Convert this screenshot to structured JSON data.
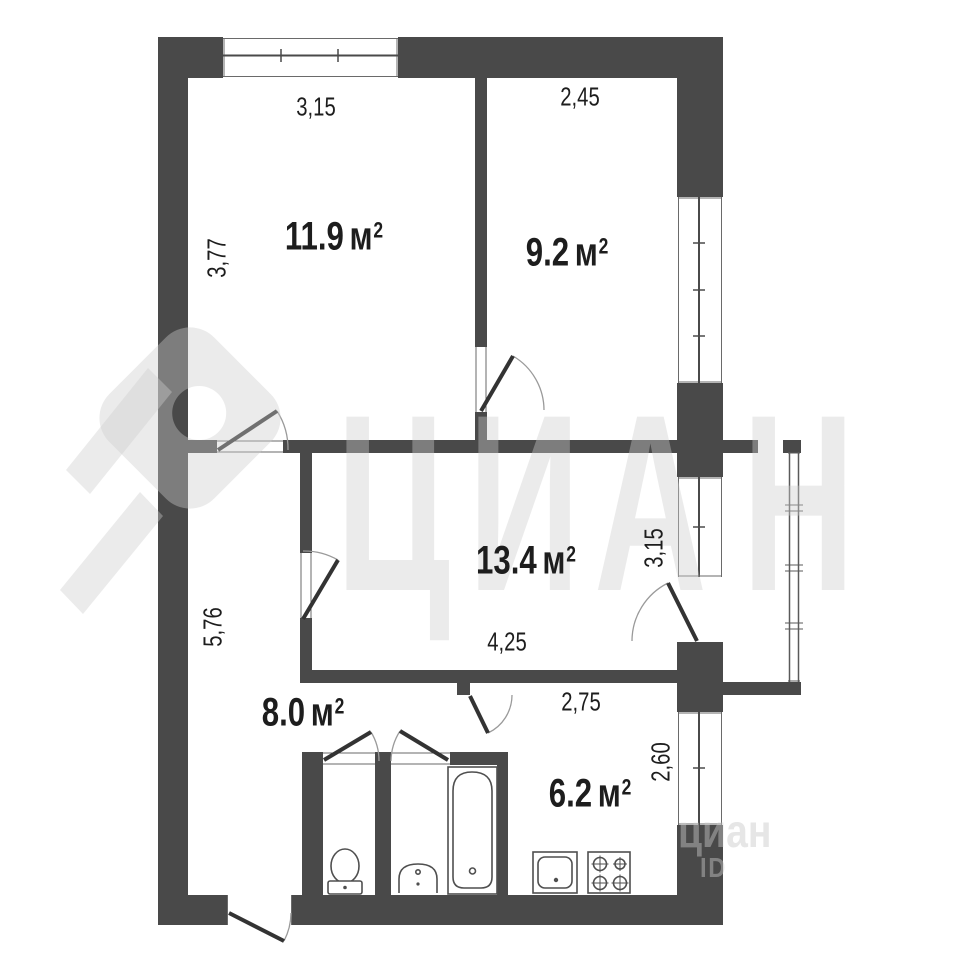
{
  "plan": {
    "rooms": [
      {
        "key": "room-a",
        "area": "11.9",
        "area_unit": "м",
        "area_sup": "2",
        "dim_top": "3,15",
        "dim_left": "3,77"
      },
      {
        "key": "room-b",
        "area": "9.2",
        "area_unit": "м",
        "area_sup": "2",
        "dim_top": "2,45"
      },
      {
        "key": "room-c",
        "area": "13.4",
        "area_unit": "м",
        "area_sup": "2",
        "dim_bottom": "4,25",
        "dim_right": "3,15"
      },
      {
        "key": "hallway",
        "area": "8.0",
        "area_unit": "м",
        "area_sup": "2",
        "dim_left": "5,76"
      },
      {
        "key": "kitchen",
        "area": "6.2",
        "area_unit": "м",
        "area_sup": "2",
        "dim_top": "2,75",
        "dim_right": "2,60"
      }
    ]
  },
  "watermark": {
    "letter_1": "Ц",
    "letter_2": "И",
    "letter_3": "А",
    "letter_4": "Н",
    "brand_small": "циан",
    "id_small": "ID"
  },
  "colors": {
    "wall": "#494949",
    "window_line": "#5a5a5a",
    "door_line": "#333333",
    "arc_line": "#999999",
    "fixture_line": "#4f4f4f",
    "label_text": "#1d1d1d",
    "watermark": "#ededed",
    "background": "#ffffff"
  }
}
